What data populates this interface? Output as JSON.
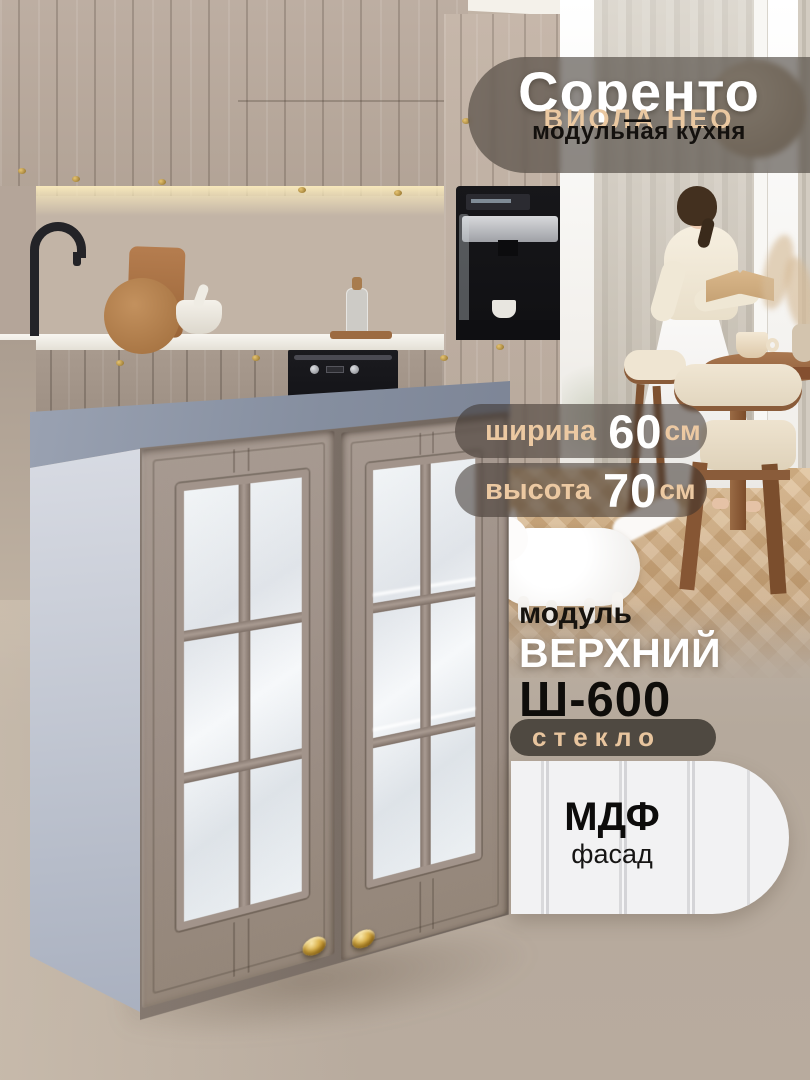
{
  "brand": {
    "title": "Соренто",
    "dash": "—",
    "subtitle": "ВИОЛА НЕО",
    "tagline": "модульная кухня"
  },
  "specs": [
    {
      "label": "ширина",
      "value": "60",
      "unit": "см"
    },
    {
      "label": "высота",
      "value": "70",
      "unit": "см"
    }
  ],
  "module": {
    "kicker": "модуль",
    "name": "ВЕРХНИЙ",
    "code": "Ш-600",
    "feature": "стекло"
  },
  "material": {
    "title": "МДФ",
    "subtitle": "фасад"
  },
  "colors": {
    "accent_tan": "#eac8a1",
    "badge_dark": "#3e3730",
    "feature_badge": "#4a433c",
    "card_bg": "#f2f2f3",
    "text_dark": "#14110e",
    "text_light": "#ffffff",
    "cabinet_door": "#9c8e85",
    "cabinet_top": "#8a92a3",
    "knob_gold": "#caa23f"
  }
}
